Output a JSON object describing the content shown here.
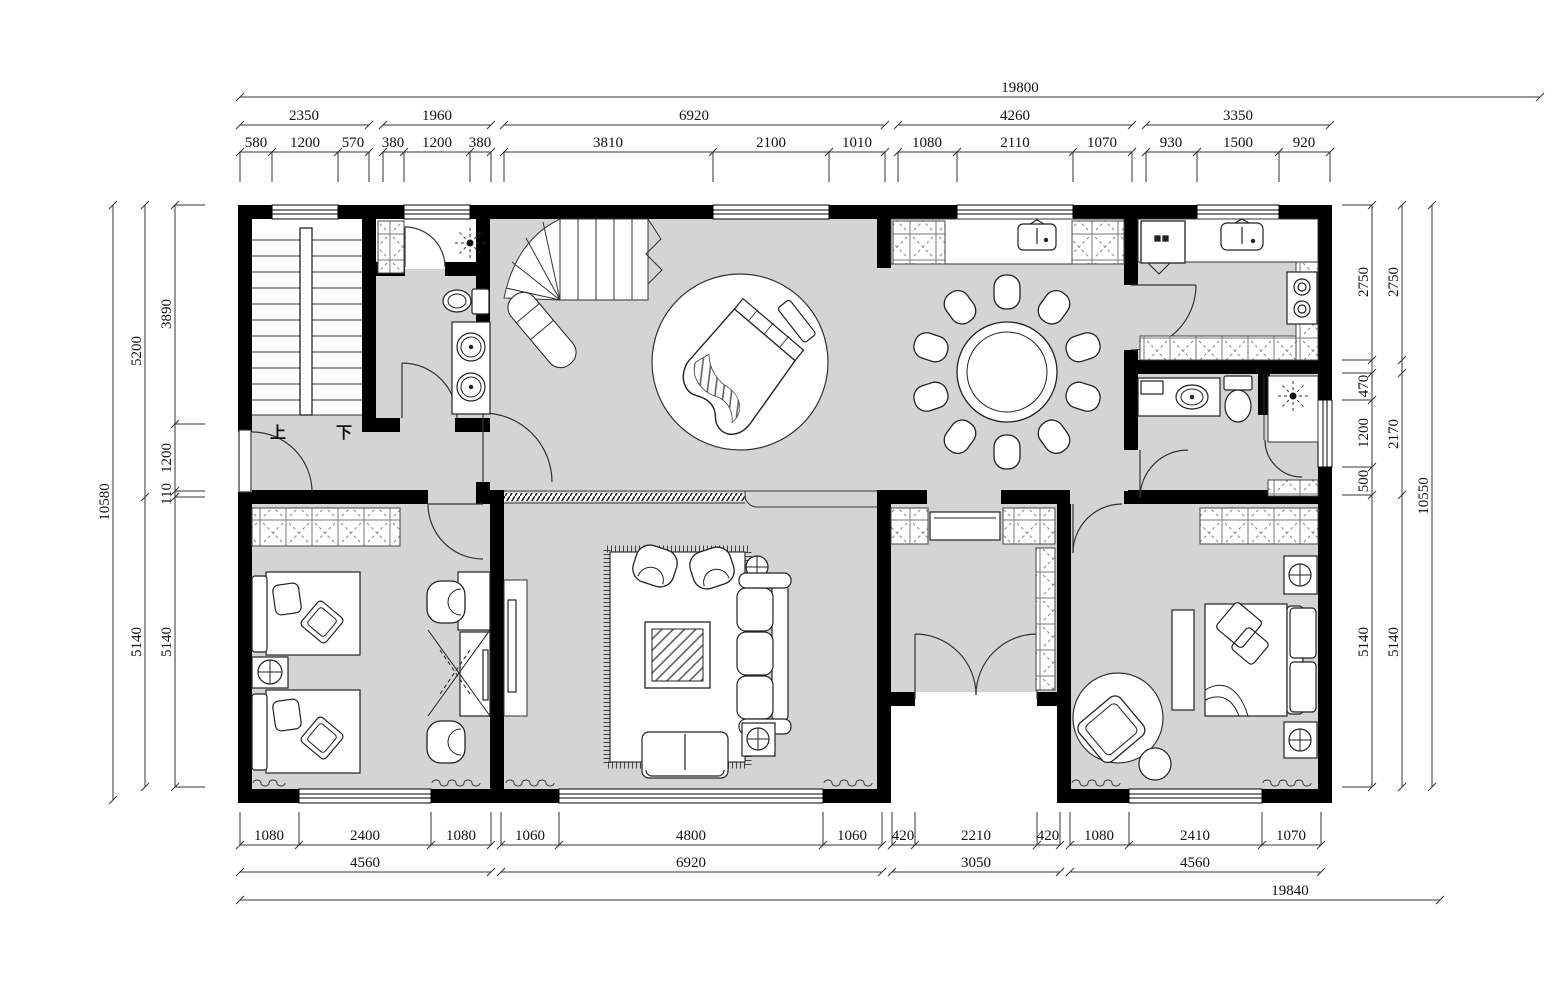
{
  "palette": {
    "floor": "#d4d4d4",
    "wall": "#000000",
    "line": "#333333"
  },
  "labels": {
    "up": "上",
    "down": "下"
  },
  "dims": {
    "top": {
      "overall": "19800",
      "groups": [
        "2350",
        "1960",
        "6920",
        "4260",
        "3350"
      ],
      "fine": [
        "580",
        "1200",
        "570",
        "380",
        "1200",
        "380",
        "3810",
        "2100",
        "1010",
        "1080",
        "2110",
        "1070",
        "930",
        "1500",
        "920"
      ]
    },
    "bottom": {
      "overall": "19840",
      "groups": [
        "4560",
        "6920",
        "3050",
        "4560"
      ],
      "fine": [
        "1080",
        "2400",
        "1080",
        "1060",
        "4800",
        "1060",
        "420",
        "2210",
        "420",
        "1080",
        "2410",
        "1070"
      ]
    },
    "left": {
      "overall": "10580",
      "groups": [
        "5200",
        "5140"
      ],
      "fine": [
        "3890",
        "1200",
        "110",
        "5140"
      ]
    },
    "right": {
      "overall": "10550",
      "groups": [
        "2750",
        "2170",
        "5140"
      ],
      "fine": [
        "2750",
        "470",
        "1200",
        "500",
        "5140"
      ]
    }
  }
}
